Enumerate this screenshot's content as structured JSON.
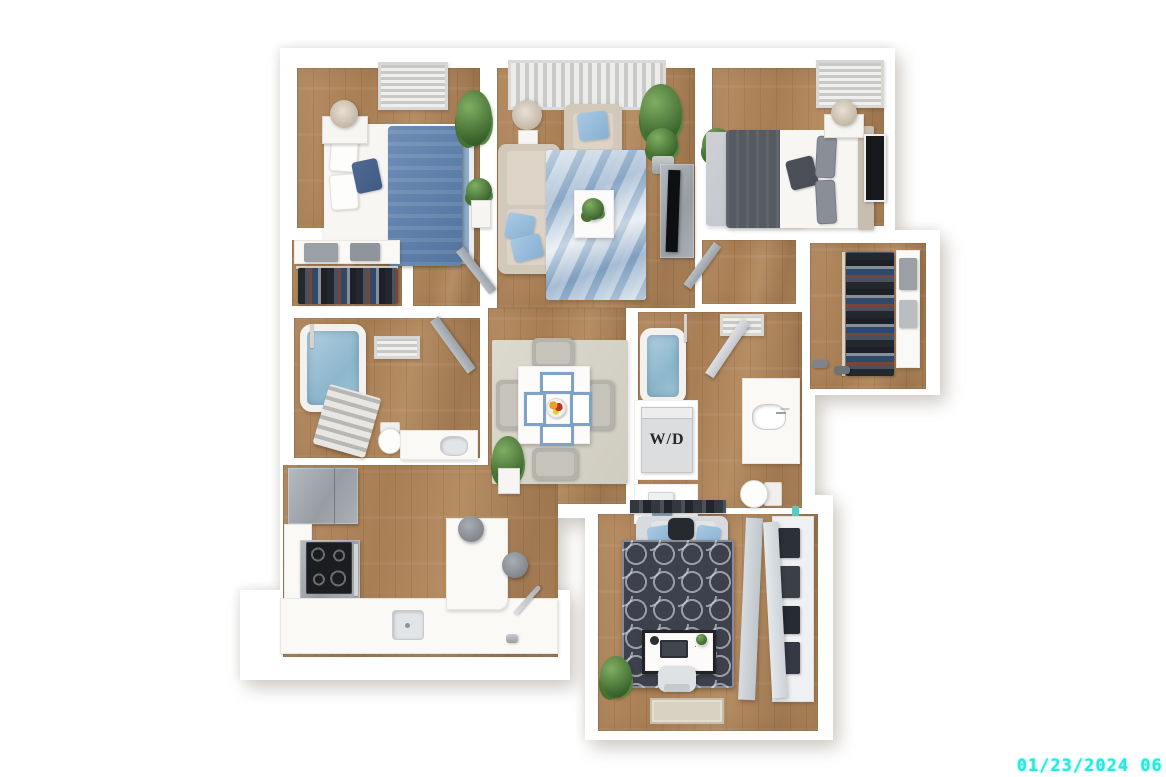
{
  "scene": {
    "type": "3d-floor-plan-render",
    "description": "Top-down 3D rendering of a two-bedroom two-bathroom apartment with living room, dining area, kitchen, den and walk-in closet on a white background",
    "background_color": "#FFFFFF"
  },
  "labels": {
    "washer_dryer": "W/D"
  },
  "overlay": {
    "timestamp": "01/23/2024 06:",
    "timestamp_color": "#25E9DF"
  },
  "palette": {
    "wood_floor": "#AC8257",
    "wall": "#FFFFFF",
    "accent_pillow_blue": "#8FB5D6",
    "bedding_blue": "#5C7EA8",
    "marble_rug_blue": "#9DB8D2",
    "trellis_rug_dark": "#3C414D",
    "furniture_beige": "#D3C9BB",
    "appliance_gray": "#A7ADB2",
    "plant_green": "#4E7C3F",
    "tub_water_blue": "#9DC2D4",
    "bathroom_rug_gray": "#C9CCD1"
  },
  "rooms": [
    {
      "id": "bedroom-1",
      "contents": [
        "bed-with-blue-duvet",
        "white-pillows",
        "navy-accent-pillow",
        "blue-striped-rug",
        "nightstand",
        "table-lamp",
        "potted-plants",
        "ceiling-vent",
        "door"
      ]
    },
    {
      "id": "bedroom-1-closet",
      "contents": [
        "shelf",
        "storage-boxes",
        "hanging-clothes"
      ]
    },
    {
      "id": "living-room",
      "contents": [
        "window-blinds",
        "floor-lamp",
        "armchair",
        "sofa",
        "blue-throw-pillows",
        "blue-marble-rug",
        "coffee-table",
        "potted-plants",
        "tv-console",
        "television"
      ]
    },
    {
      "id": "bedroom-2",
      "contents": [
        "bed-with-gray-blanket",
        "beige-headboard",
        "gray-rug",
        "nightstand",
        "table-lamp",
        "wall-art",
        "potted-plant",
        "ceiling-vent"
      ]
    },
    {
      "id": "walk-in-closet",
      "contents": [
        "hanging-clothes",
        "closet-rod",
        "shelving-column",
        "storage-bins",
        "shoes"
      ]
    },
    {
      "id": "bathroom-1",
      "contents": [
        "bathtub",
        "shower-pole",
        "towel-rack",
        "toilet",
        "vanity-with-sink",
        "ceiling-vent",
        "door"
      ]
    },
    {
      "id": "dining-area",
      "contents": [
        "square-dining-table",
        "blue-placemats",
        "fruit-bowl",
        "four-chairs",
        "area-rug",
        "potted-plant"
      ]
    },
    {
      "id": "bathroom-2",
      "contents": [
        "bathtub",
        "shower-pole",
        "vanity-with-sink",
        "toilet",
        "washer-dryer-closet",
        "linen-shelf-with-towels",
        "slippers",
        "ceiling-vent",
        "door",
        "bath-accessory"
      ]
    },
    {
      "id": "kitchen",
      "contents": [
        "refrigerator",
        "range-with-black-cooktop",
        "left-counter",
        "bottom-counter",
        "sink",
        "tall-faucet",
        "peninsula-island",
        "two-stools"
      ]
    },
    {
      "id": "den",
      "contents": [
        "wall-shelf",
        "loveseat",
        "blue-pillows",
        "dark-trellis-rug",
        "desk",
        "laptop",
        "desk-lamp",
        "office-chair",
        "potted-plants",
        "storage-closet-shelves",
        "open-bifold-doors",
        "entry-doormat"
      ]
    }
  ]
}
